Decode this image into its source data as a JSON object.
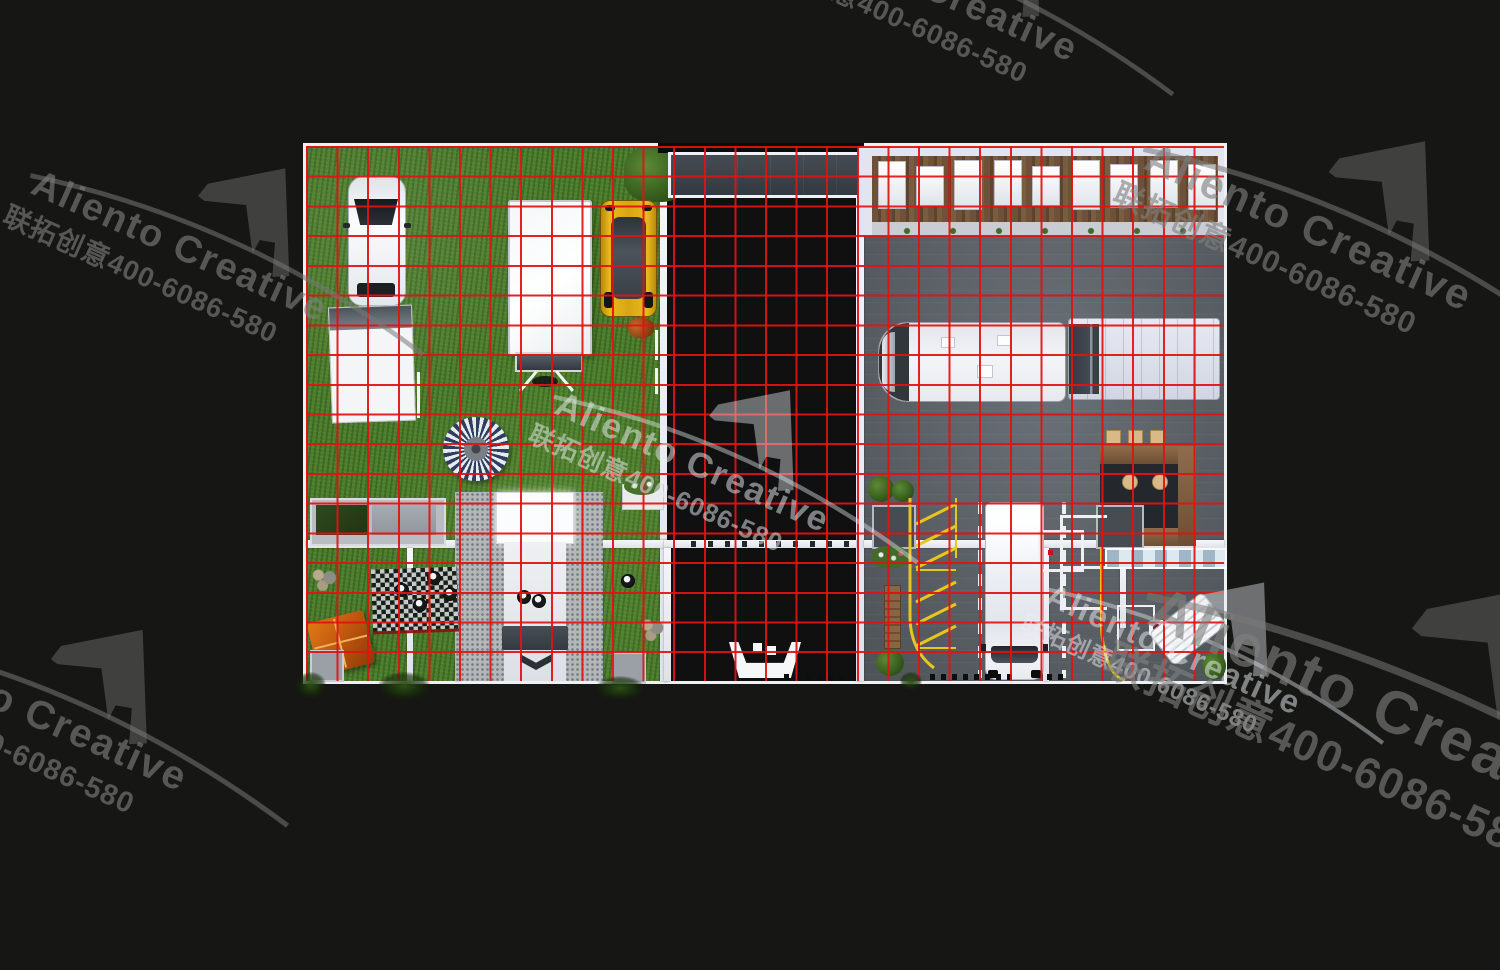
{
  "watermark": {
    "brand": "Aliento Creative",
    "phone": "联拓创意400-6086-580"
  },
  "grid": {
    "color": "#e11212",
    "columns": 30,
    "rows": 18
  },
  "colors": {
    "background": "#161614",
    "grid_red": "#e11212",
    "grass_green": "#4c7c2d",
    "concrete_mid": "#7d838a",
    "concrete_right": "#5a6065",
    "roof_charcoal": "#394046",
    "wood_brown": "#6d5138",
    "wall_white": "#eef0f4",
    "sportscar_yellow": "#d8a513",
    "tent_orange": "#c2590f",
    "parasol_navy": "#2c3f63",
    "lane_yellow": "#e8c51f",
    "watermark_gray": "#6e6e6c"
  }
}
